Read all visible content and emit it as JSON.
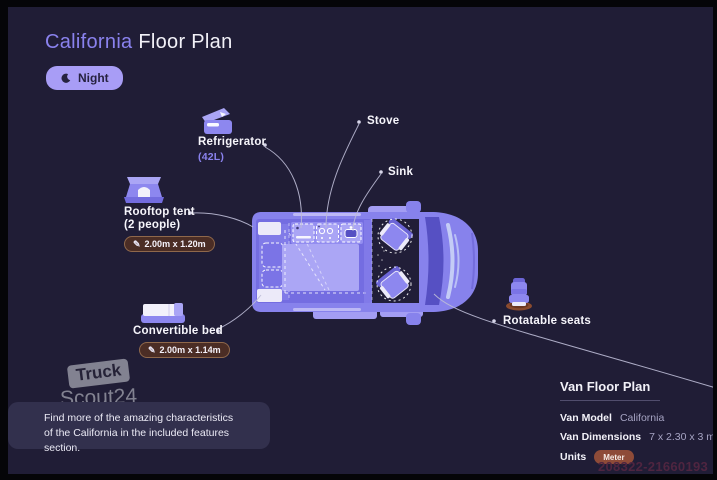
{
  "header": {
    "title_highlight": "California",
    "title_rest": "Floor Plan",
    "mode_label": "Night"
  },
  "callouts": {
    "refrigerator": {
      "label": "Refrigerator",
      "sub": "(42L)"
    },
    "stove": {
      "label": "Stove"
    },
    "sink": {
      "label": "Sink"
    },
    "rooftop_tent": {
      "label": "Rooftop tent",
      "sub": "(2 people)",
      "badge": "2.00m x 1.20m"
    },
    "convertible_bed": {
      "label": "Convertible bed",
      "badge": "2.00m x 1.14m"
    },
    "rotatable_seats": {
      "label": "Rotatable seats"
    }
  },
  "icons": {
    "pencil_glyph": "✎"
  },
  "watermark": {
    "line1": "Truck",
    "line2": "Scout24"
  },
  "note": {
    "line1": "Find more of the amazing characteristics",
    "line2": "of the California in the included features section."
  },
  "info": {
    "title": "Van Floor Plan",
    "model_label": "Van Model",
    "model_value": "California",
    "dims_label": "Van Dimensions",
    "dims_value": "7 x 2.30 x 3 m",
    "units_label": "Units",
    "units_value": "Meter"
  },
  "id_code": "208322-21660193",
  "colors": {
    "background": "#201d36",
    "frame": "#050508",
    "accent_purple": "#8a82ee",
    "van_body": "#8782ec",
    "bed_light": "#aba6f5",
    "cab_dark": "#211e38",
    "badge_brown": "#4b2d25",
    "unit_badge": "#8e4b38",
    "pill": "#a89df6",
    "note_panel": "#32304d",
    "watermark_gray": "#8d8d9b"
  }
}
